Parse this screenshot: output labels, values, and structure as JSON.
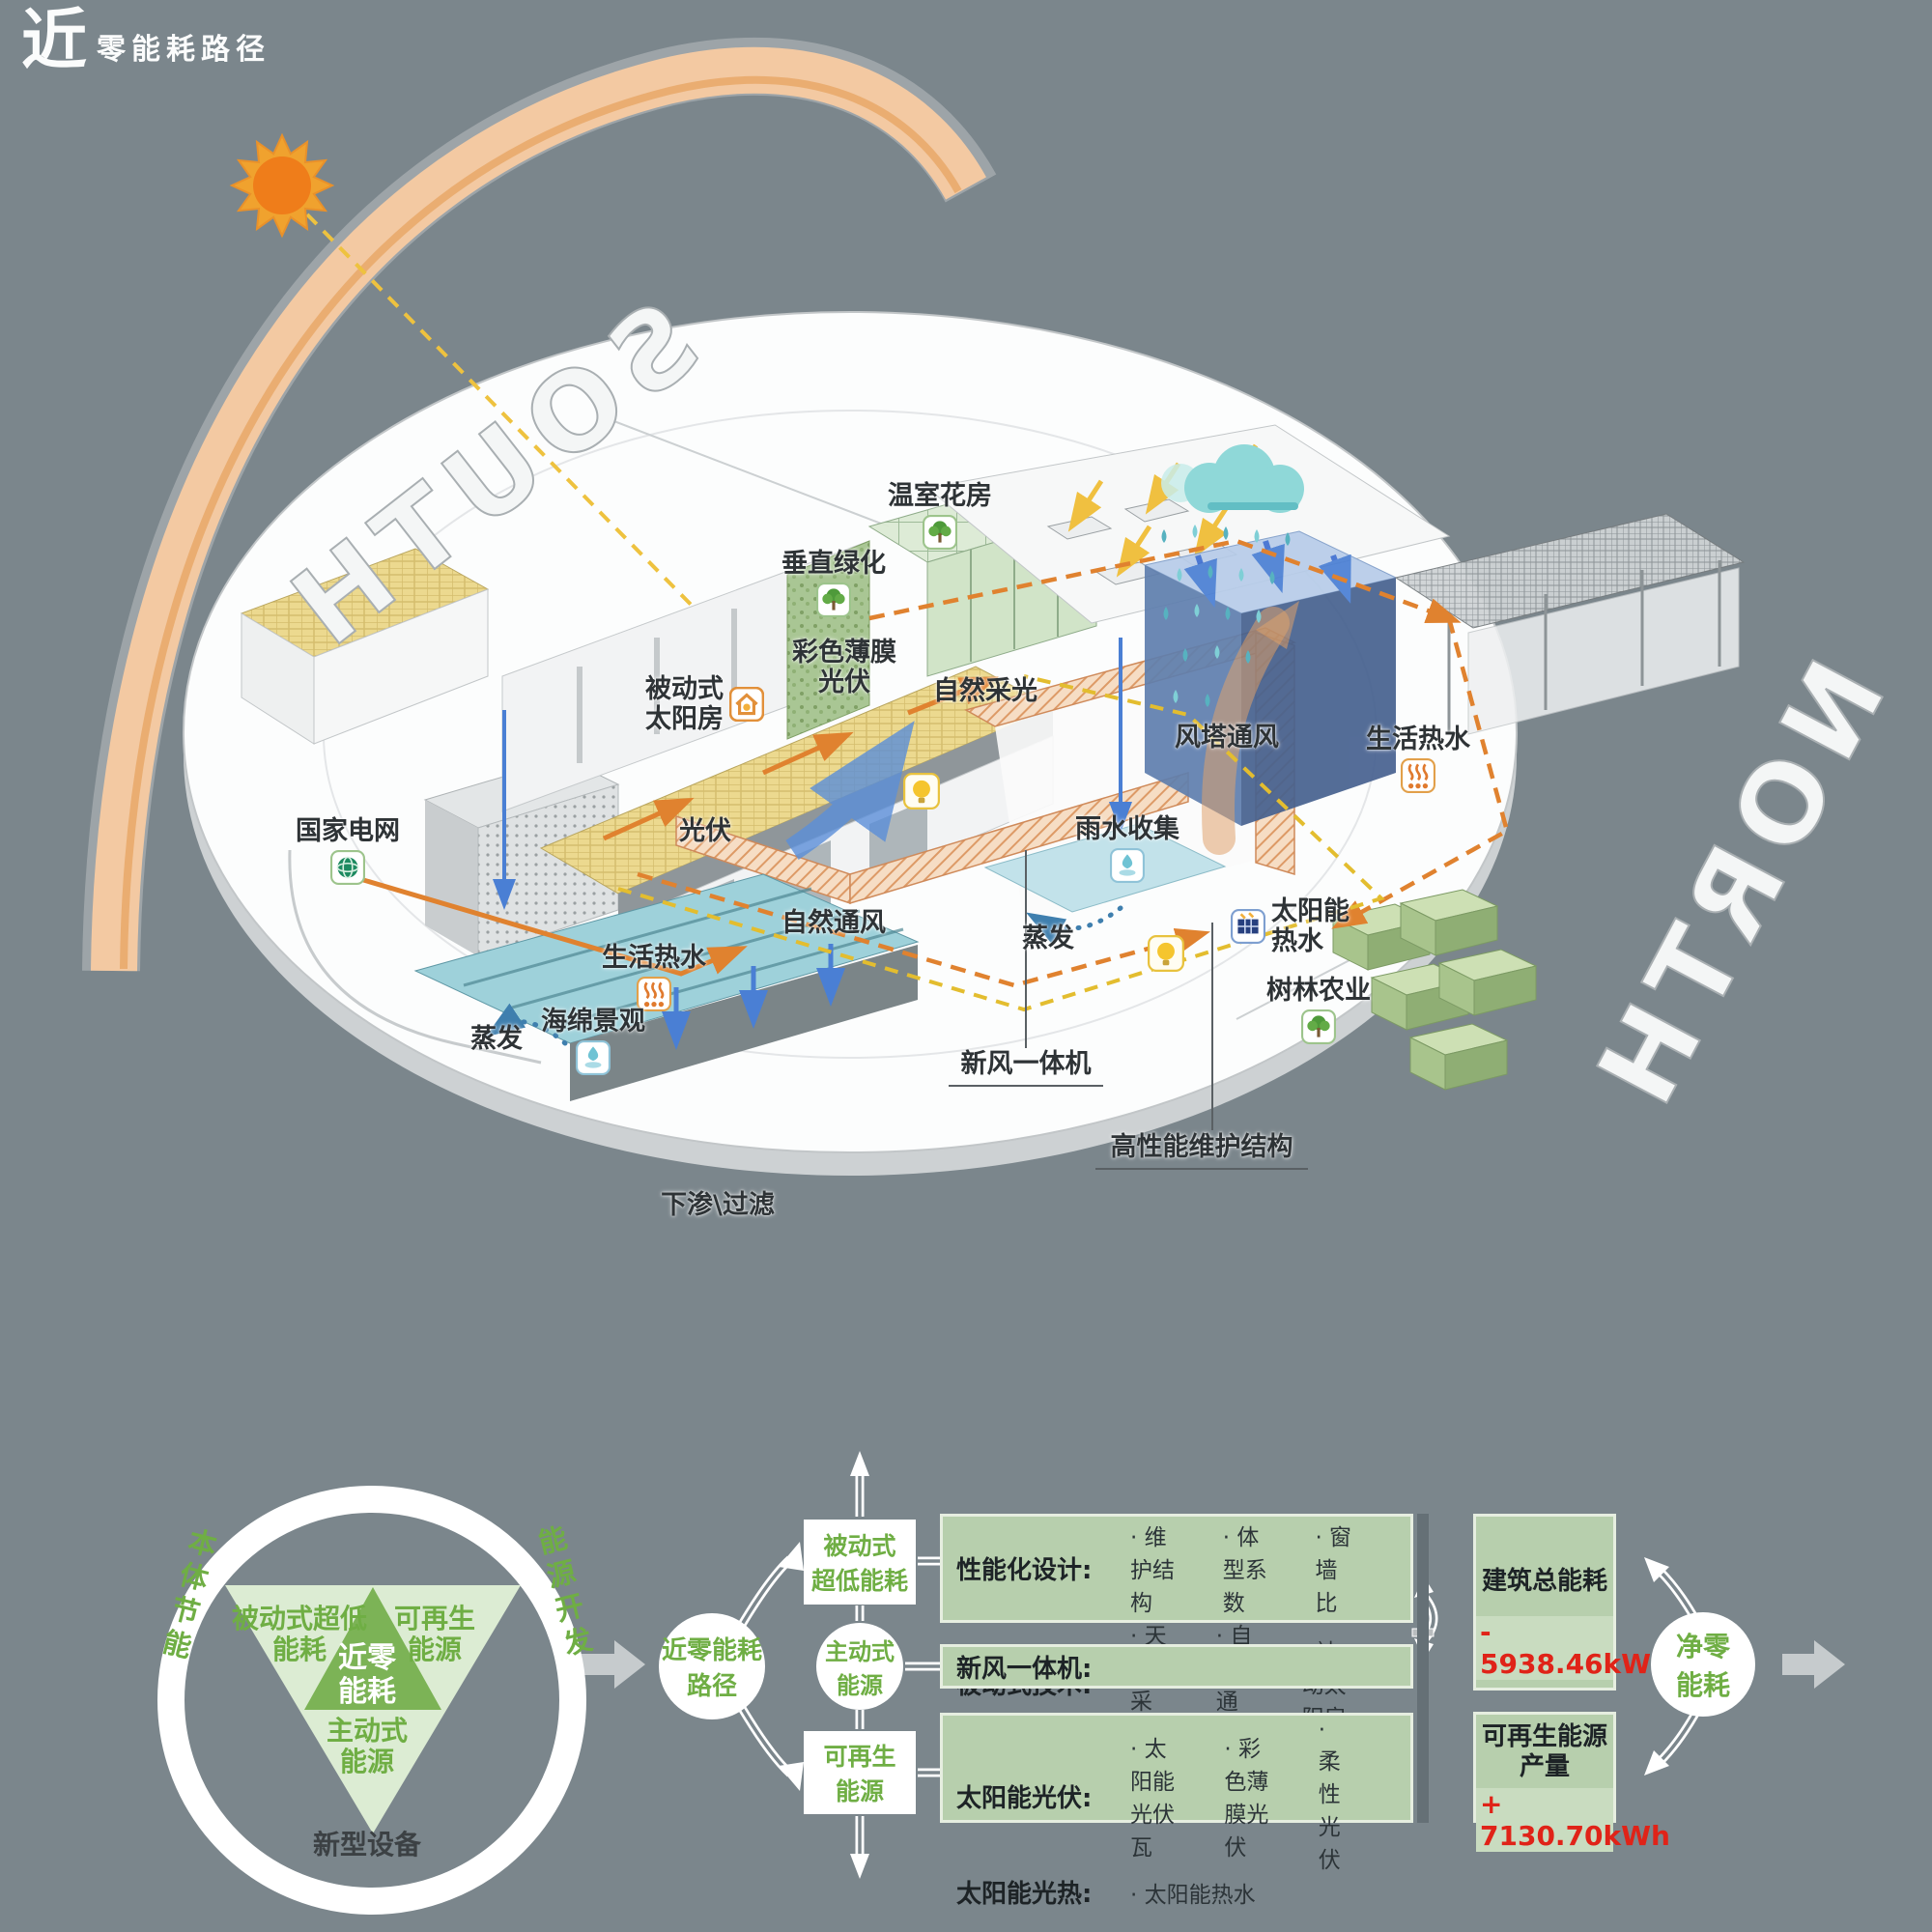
{
  "logo": {
    "big": "近",
    "small": "零能耗路径"
  },
  "colors": {
    "background": "#7B868C",
    "accent_green": "#6fae44",
    "panel_green": "#b7cfad",
    "triangle_dark": "#7cb356",
    "triangle_light": "#dcecd3",
    "value_red": "#e02318",
    "arc_orange": "#f3c9a2",
    "sun_orange": "#ef7d1a",
    "pv_yellow": "#ecd98f",
    "tower_blue": "#5f7fae",
    "water_teal": "#9ed1da"
  },
  "scene": {
    "compass": {
      "south": "SOUTH",
      "north": "NORTH"
    },
    "labels": {
      "grid": "国家电网",
      "greenhouse": "温室花房",
      "vertical_green": "垂直绿化",
      "film_pv": "彩色薄膜\n光伏",
      "passive_solar": "被动式\n太阳房",
      "daylight": "自然采光",
      "pv": "光伏",
      "nat_vent": "自然通风",
      "dhw_left": "生活热水",
      "wind_tower": "风塔通风",
      "rain": "雨水收集",
      "dhw_right": "生活热水",
      "evap_mid": "蒸发",
      "solar_hw": "太阳能\n热水",
      "forest": "树林农业",
      "fresh_air": "新风一体机",
      "envelope": "高性能维护结构",
      "evap_left": "蒸发",
      "sponge": "海绵景观",
      "infiltration": "下渗\\过滤"
    }
  },
  "cycle": {
    "ring_left": "本体节能",
    "ring_right": "能源开发",
    "ring_bottom": "新型设备",
    "tri_left": "被动式超低\n能耗",
    "tri_right": "可再生\n能源",
    "tri_center": "近零\n能耗",
    "tri_bottom": "主动式\n能源"
  },
  "flow": {
    "start": "近零能耗\n路径",
    "node1": "被动式\n超低能耗",
    "node2": "主动式\n能源",
    "node3": "可再生\n能源"
  },
  "panels": {
    "p1": {
      "rows": [
        {
          "label": "性能化设计:",
          "items": [
            "· 维护结构",
            "· 体型系数",
            "· 窗墙比"
          ]
        },
        {
          "label": "被动式技术:",
          "items": [
            "· 天然采光",
            "· 自然通风",
            "· 被动太阳房"
          ]
        }
      ]
    },
    "p2": {
      "label": "新风一体机:"
    },
    "p3": {
      "rows": [
        {
          "label": "太阳能光伏:",
          "items": [
            "· 太阳能光伏瓦",
            "· 彩色薄膜光伏",
            "· 柔性光伏"
          ]
        },
        {
          "label": "太阳能光热:",
          "items": [
            "· 太阳能热水"
          ]
        }
      ]
    }
  },
  "results": {
    "total_label": "建筑总能耗",
    "total_value": "- 5938.46kWh",
    "renew_label": "可再生能源\n产量",
    "renew_value": "+ 7130.70kWh",
    "net": "净零\n能耗"
  }
}
